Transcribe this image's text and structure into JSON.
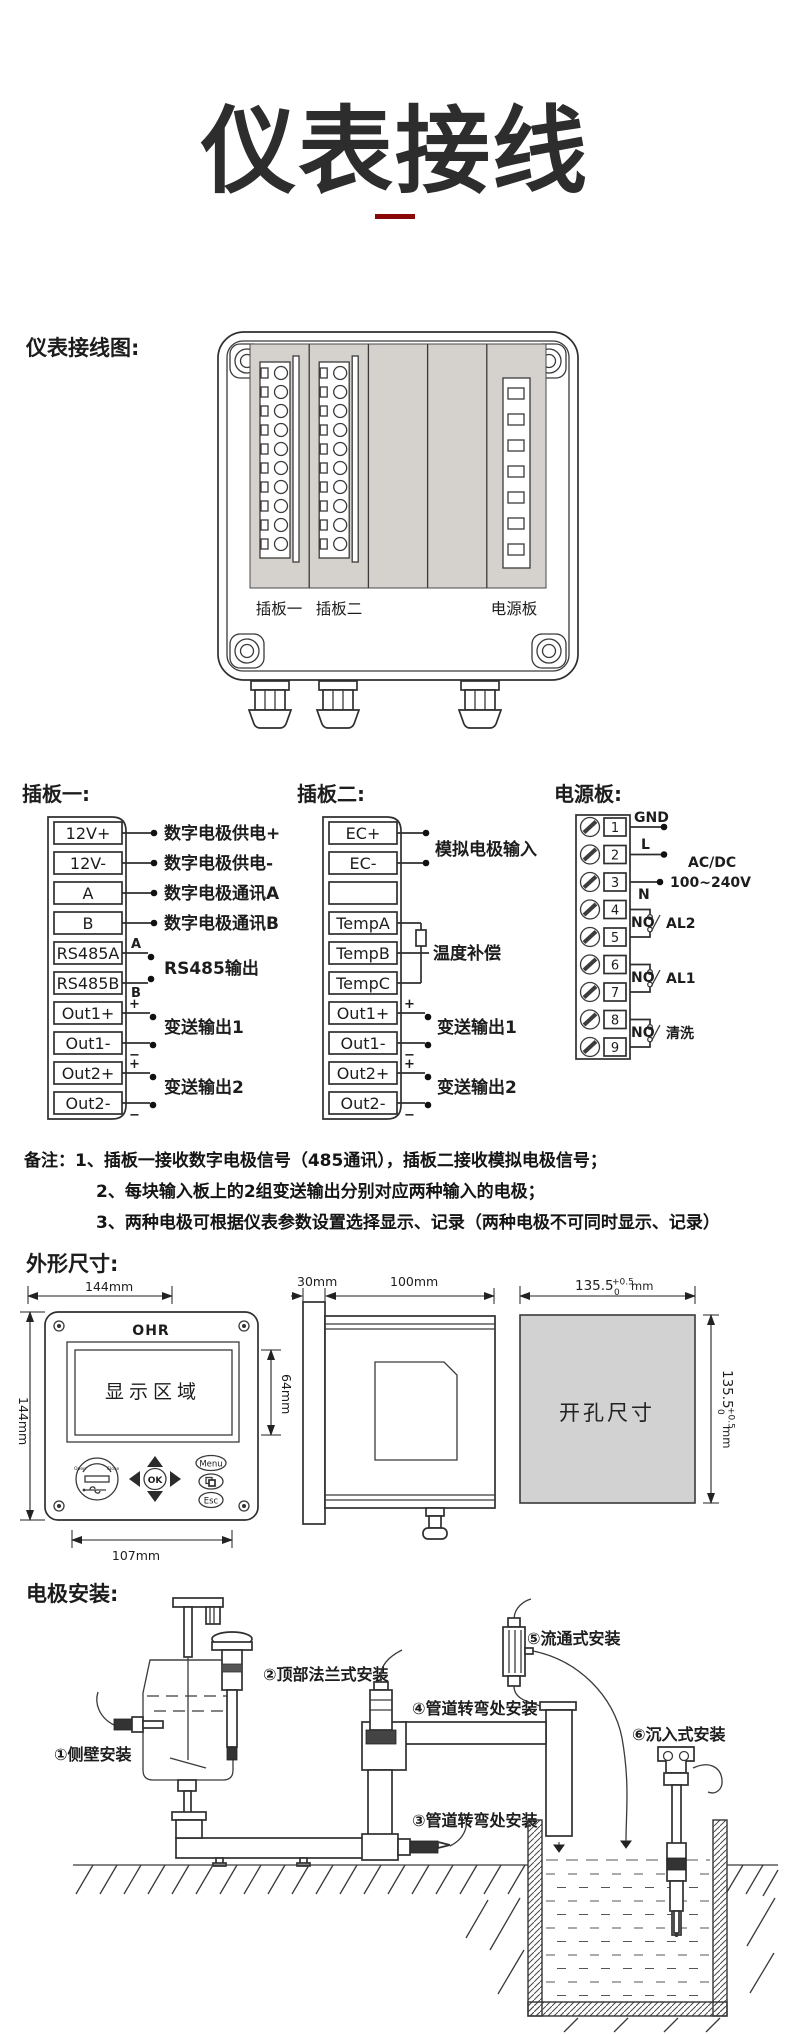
{
  "page": {
    "title": "仪表接线"
  },
  "wiring": {
    "section_label": "仪表接线图:",
    "board1_label": "插板一",
    "board2_label": "插板二",
    "power_label": "电源板"
  },
  "board1": {
    "title": "插板一:",
    "terminals": [
      "12V+",
      "12V-",
      "A",
      "B",
      "RS485A",
      "RS485B",
      "Out1+",
      "Out1-",
      "Out2+",
      "Out2-"
    ],
    "ann_supply_pos": "数字电极供电+",
    "ann_supply_neg": "数字电极供电-",
    "ann_comm_a": "数字电极通讯A",
    "ann_comm_b": "数字电极通讯B",
    "ann_rs485": "RS485输出",
    "ann_out1": "变送输出1",
    "ann_out2": "变送输出2",
    "mark_a": "A",
    "mark_b": "B",
    "mark_plus": "+",
    "mark_minus": "−"
  },
  "board2": {
    "title": "插板二:",
    "terminals": [
      "EC+",
      "EC-",
      "",
      "TempA",
      "TempB",
      "TempC",
      "Out1+",
      "Out1-",
      "Out2+",
      "Out2-"
    ],
    "ann_input": "模拟电极输入",
    "ann_temp": "温度补偿",
    "ann_out1": "变送输出1",
    "ann_out2": "变送输出2",
    "mark_plus": "+",
    "mark_minus": "−"
  },
  "power": {
    "title": "电源板:",
    "numbers": [
      "1",
      "2",
      "3",
      "4",
      "5",
      "6",
      "7",
      "8",
      "9"
    ],
    "gnd": "GND",
    "l": "L",
    "n": "N",
    "acdc_line1": "AC/DC",
    "acdc_line2": "100~240V",
    "no1": "NO",
    "no2": "NO",
    "no3": "NO",
    "al2": "AL2",
    "al1": "AL1",
    "wash": "清洗"
  },
  "notes": {
    "prefix": "备注：",
    "line1": "1、插板一接收数字电极信号（485通讯），插板二接收模拟电极信号；",
    "line2": "2、每块输入板上的2组变送输出分别对应两种输入的电极；",
    "line3": "3、两种电极可根据仪表参数设置选择显示、记录（两种电极不可同时显示、记录）"
  },
  "dimensions": {
    "section_label": "外形尺寸:",
    "front_width": "144mm",
    "front_height": "144mm",
    "display_height": "64mm",
    "front_bottom": "107mm",
    "side_depth1": "30mm",
    "side_depth2": "100mm",
    "cutout_value": "135.5",
    "cutout_tol_up": "+0.5",
    "cutout_tol_dn": "0",
    "cutout_unit": "mm",
    "logo": "OHR",
    "display_label": "显示区域",
    "cutout_label": "开孔尺寸",
    "btn_ok": "OK",
    "btn_menu": "Menu",
    "btn_esc": "Esc",
    "usb_open": "Open",
    "usb_close": "Close"
  },
  "installation": {
    "section_label": "电极安装:",
    "item1": "①侧壁安装",
    "item2": "②顶部法兰式安装",
    "item3": "③管道转弯处安装",
    "item4": "④管道转弯处安装",
    "item5": "⑤流通式安装",
    "item6": "⑥沉入式安装"
  }
}
